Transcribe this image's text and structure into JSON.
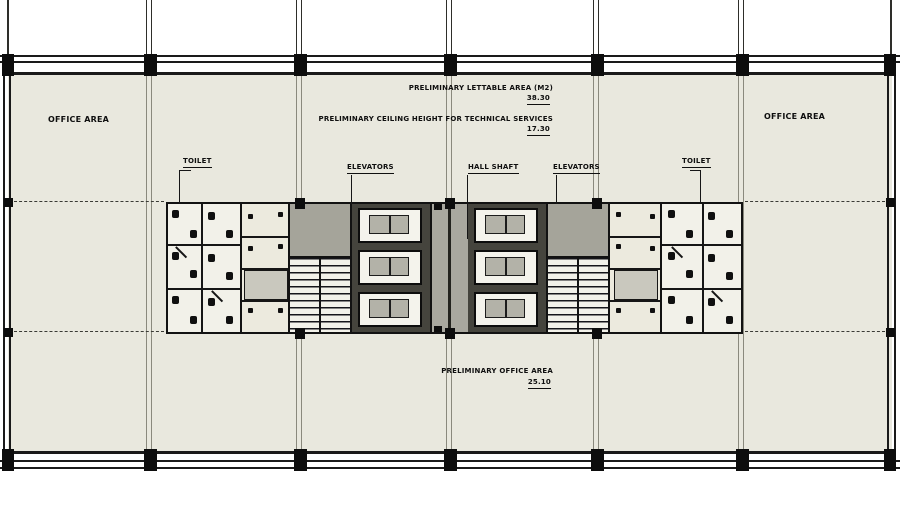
{
  "drawing": {
    "type": "architectural-floor-plan",
    "colors": {
      "background": "#ffffff",
      "floor_fill": "#e9e8de",
      "wall_line": "#1a1a1a",
      "core_fill": "#d9d8ce",
      "corridor_fill": "#a9a89f",
      "lobby_fill": "#a5a49a",
      "elevator_bank_fill": "#45443d",
      "elevator_car_fill": "#b3b2a8"
    },
    "labels": {
      "area_note_top_1": "PRELIMINARY LETTABLE AREA (M2)",
      "area_note_top_1_value": "38.30",
      "area_note_top_2": "PRELIMINARY CEILING HEIGHT FOR TECHNICAL SERVICES",
      "area_note_top_2_value": "17.30",
      "office_left": "OFFICE AREA",
      "office_right": "OFFICE AREA",
      "toilet_left": "TOILET",
      "toilet_right": "TOILET",
      "elevators_left": "ELEVATORS",
      "elevators_right": "ELEVATORS",
      "hall_shaft": "HALL SHAFT",
      "area_note_bottom": "PRELIMINARY OFFICE AREA",
      "area_note_bottom_value": "25.10"
    }
  }
}
